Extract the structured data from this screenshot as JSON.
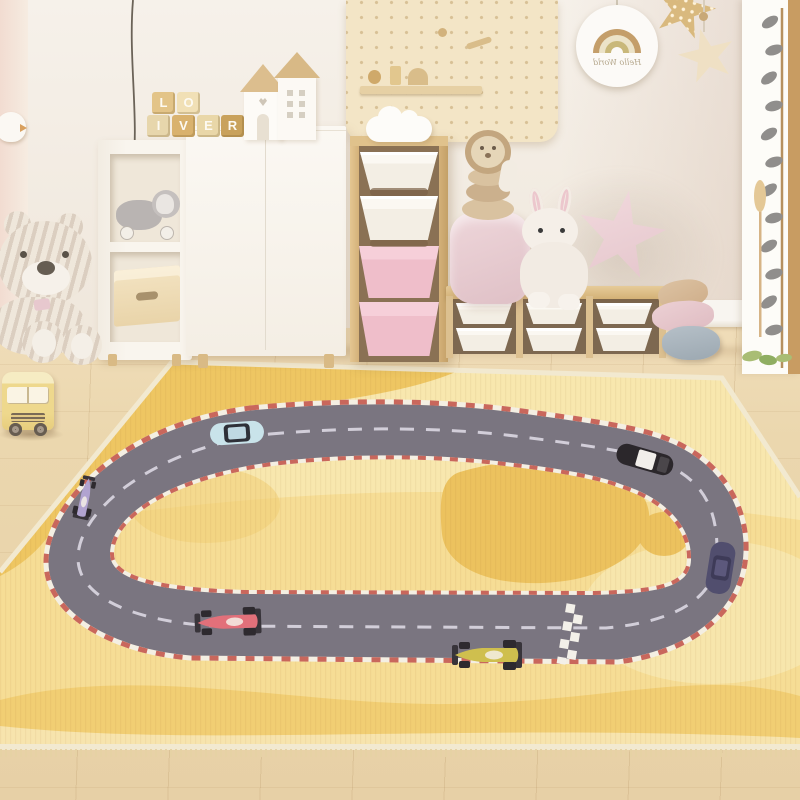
{
  "scene": {
    "description": "Children's playroom with a yellow race-track play rug, toy cars, plush toys and storage furniture"
  },
  "wall": {
    "hello_sign": {
      "text": "Hello World"
    },
    "letter_blocks": [
      "L",
      "O",
      "I",
      "V",
      "E",
      "R"
    ]
  },
  "palette": {
    "wall": "#f4efe8",
    "floor_wood": "#ead7af",
    "furniture_wood": "#ddbe8b",
    "bin_pink": "#efbeca",
    "star_pillow_pink": "#eed4da",
    "pouf_blue": "#a9b4bd"
  },
  "rug": {
    "base_color": "#f6dd95",
    "light_color": "#f8e7ae",
    "amber_color": "#edc45e",
    "blob_color": "#ecc25e",
    "track_color": "#7a7580",
    "curb_color": "#c9675c",
    "lane_color": "#dcd8e2",
    "cars": [
      {
        "name": "light-blue-car",
        "color": "#c9e3ea"
      },
      {
        "name": "black-white-roof-car",
        "color": "#2b272b"
      },
      {
        "name": "navy-car",
        "color": "#514e6e"
      },
      {
        "name": "purple-race-car",
        "color": "#b1a3d0"
      },
      {
        "name": "red-race-car",
        "color": "#e2707a"
      },
      {
        "name": "yellow-race-car",
        "color": "#cfbf4e"
      }
    ]
  }
}
